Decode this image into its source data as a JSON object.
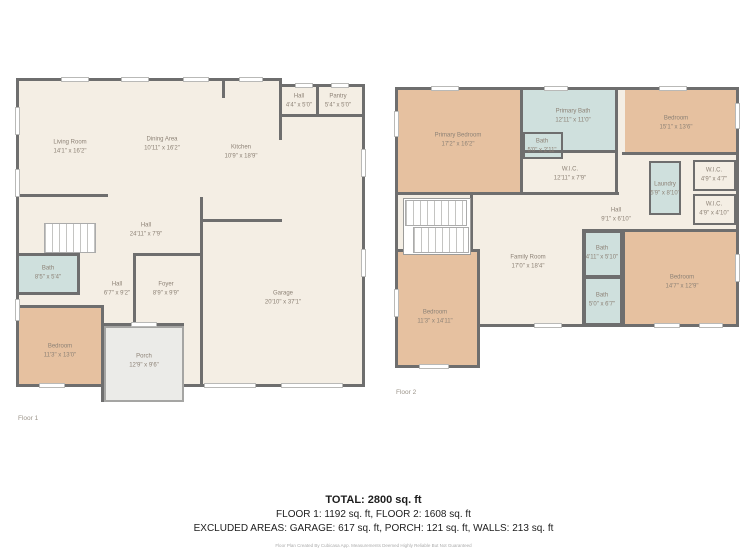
{
  "colors": {
    "wall": "#6e6e6e",
    "floor": "#f4eee4",
    "bedroom": "#e6c1a0",
    "bath": "#cfe0dd",
    "porch": "#ebebe8",
    "label": "#8d8276"
  },
  "floor1": {
    "caption": "Floor 1",
    "rooms": [
      {
        "name": "Living Room",
        "dims": "14'1\" x 16'2\""
      },
      {
        "name": "Dining Area",
        "dims": "10'11\" x 16'2\""
      },
      {
        "name": "Kitchen",
        "dims": "10'9\" x 18'9\""
      },
      {
        "name": "Hall",
        "dims": "4'4\" x 5'0\""
      },
      {
        "name": "Pantry",
        "dims": "5'4\" x 5'0\""
      },
      {
        "name": "Hall",
        "dims": "24'11\" x 7'9\""
      },
      {
        "name": "Bath",
        "dims": "8'5\" x 5'4\""
      },
      {
        "name": "Hall",
        "dims": "6'7\" x 9'2\""
      },
      {
        "name": "Foyer",
        "dims": "8'9\" x 9'9\""
      },
      {
        "name": "Bedroom",
        "dims": "11'3\" x 13'0\""
      },
      {
        "name": "Porch",
        "dims": "12'9\" x 9'6\""
      },
      {
        "name": "Garage",
        "dims": "20'10\" x 37'1\""
      }
    ]
  },
  "floor2": {
    "caption": "Floor 2",
    "rooms": [
      {
        "name": "Primary Bedroom",
        "dims": "17'2\" x 16'2\""
      },
      {
        "name": "Primary Bath",
        "dims": "12'11\" x 11'0\""
      },
      {
        "name": "Bath",
        "dims": "5'0\" x 2'11\""
      },
      {
        "name": "Bedroom",
        "dims": "15'1\" x 13'6\""
      },
      {
        "name": "W.I.C.",
        "dims": "12'11\" x 7'9\""
      },
      {
        "name": "W.I.C.",
        "dims": "4'9\" x 4'7\""
      },
      {
        "name": "Laundry",
        "dims": "5'9\" x 8'10\""
      },
      {
        "name": "W.I.C.",
        "dims": "4'9\" x 4'10\""
      },
      {
        "name": "Hall",
        "dims": "9'1\" x 6'10\""
      },
      {
        "name": "Family Room",
        "dims": "17'0\" x 18'4\""
      },
      {
        "name": "Bath",
        "dims": "4'11\" x 5'10\""
      },
      {
        "name": "Bath",
        "dims": "5'0\" x 6'7\""
      },
      {
        "name": "Bedroom",
        "dims": "11'3\" x 14'11\""
      },
      {
        "name": "Bedroom",
        "dims": "14'7\" x 12'9\""
      }
    ]
  },
  "summary": {
    "total": "TOTAL: 2800 sq. ft",
    "floors": "FLOOR 1: 1192 sq. ft, FLOOR 2: 1608 sq. ft",
    "excluded": "EXCLUDED AREAS: GARAGE: 617 sq. ft, PORCH: 121 sq. ft, WALLS: 213 sq. ft",
    "disclaimer": "Floor Plan Created By Cubicasa App. Measurements Deemed Highly Reliable But Not Guaranteed"
  }
}
